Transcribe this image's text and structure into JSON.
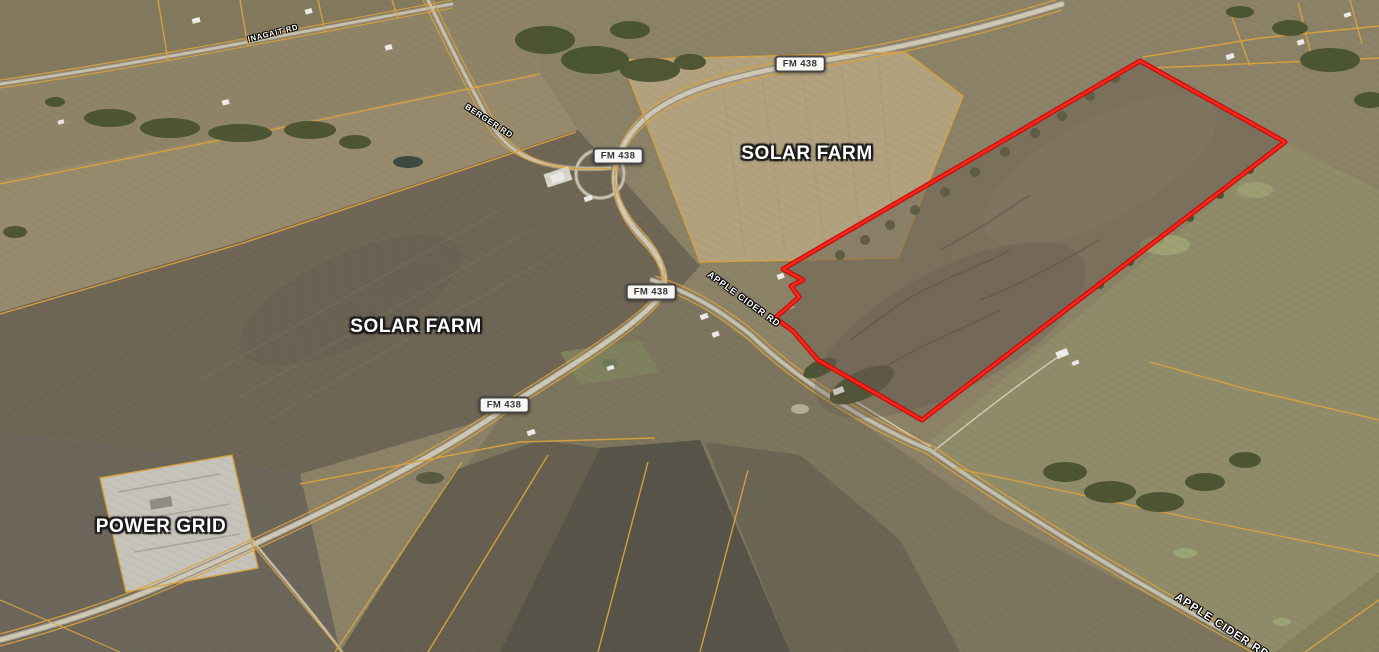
{
  "map": {
    "area_labels": [
      {
        "id": "solar-farm-north",
        "text": "SOLAR FARM"
      },
      {
        "id": "solar-farm-west",
        "text": "SOLAR FARM"
      },
      {
        "id": "power-grid",
        "text": "POWER GRID"
      }
    ],
    "route_badges": [
      {
        "id": "fm438-north",
        "text": "FM 438"
      },
      {
        "id": "fm438-interchange",
        "text": "FM 438"
      },
      {
        "id": "fm438-mid",
        "text": "FM 438"
      },
      {
        "id": "fm438-south",
        "text": "FM 438"
      }
    ],
    "road_labels": [
      {
        "id": "inagait-rd",
        "text": "INAGAIT RD"
      },
      {
        "id": "berger-rd",
        "text": "BERGER RD"
      },
      {
        "id": "apple-cider-rd",
        "text": "APPLE CIDER RD"
      },
      {
        "id": "apple-cider-rd-south",
        "text": "APPLE CIDER RD"
      }
    ],
    "colors": {
      "highlighted_parcel_outline": "#ff2617",
      "parcel_boundary_lines": "#dba33e",
      "badge_background": "#f7f6f2",
      "badge_text": "#333333",
      "label_text": "#ffffff"
    }
  }
}
